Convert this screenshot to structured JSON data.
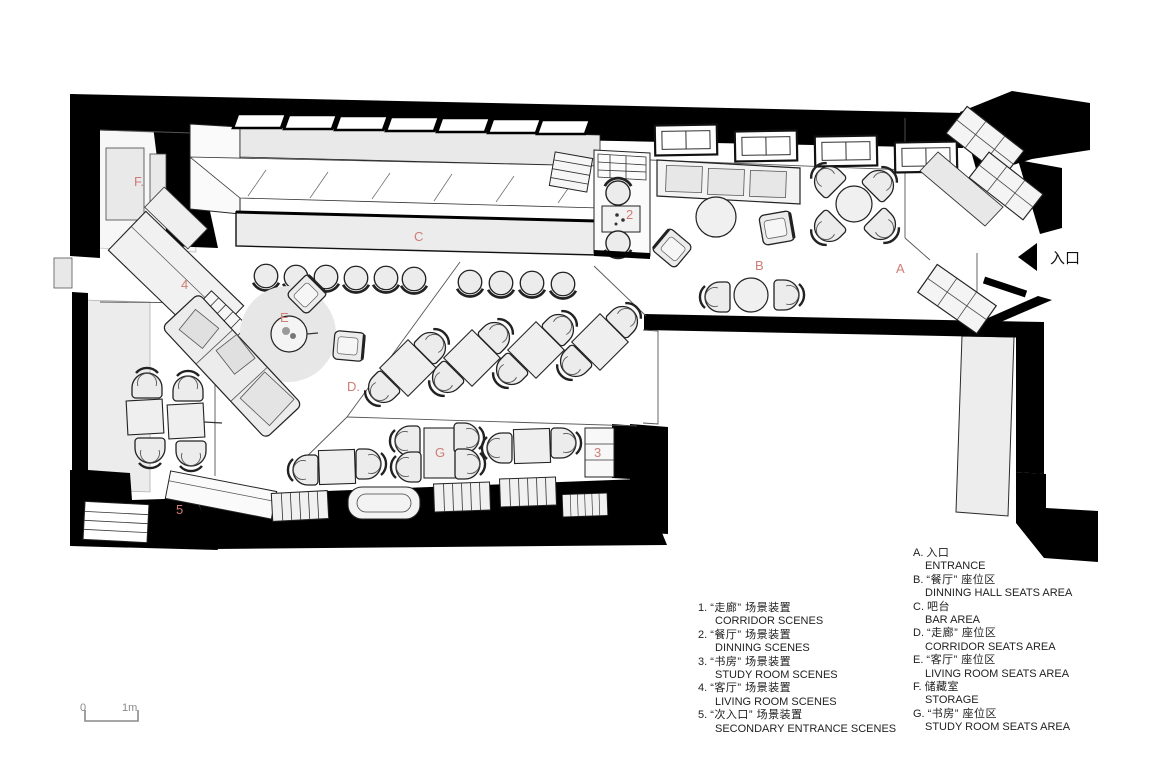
{
  "plan": {
    "entrance_label": "入口",
    "labels": [
      {
        "id": "F",
        "text": "F.",
        "meaning": "storage"
      },
      {
        "id": "C",
        "text": "C",
        "meaning": "bar area"
      },
      {
        "id": "2",
        "text": "2",
        "meaning": "dining scenes installation"
      },
      {
        "id": "B",
        "text": "B",
        "meaning": "dining hall seats area"
      },
      {
        "id": "A",
        "text": "A",
        "meaning": "entrance"
      },
      {
        "id": "4",
        "text": "4",
        "meaning": "living room scenes installation"
      },
      {
        "id": "E",
        "text": "E",
        "meaning": "living room seats area"
      },
      {
        "id": "D",
        "text": "D.",
        "meaning": "corridor seats area"
      },
      {
        "id": "G",
        "text": "G",
        "meaning": "study room seats area"
      },
      {
        "id": "3",
        "text": "3",
        "meaning": "study room scenes installation"
      },
      {
        "id": "5",
        "text": "5",
        "meaning": "secondary entrance scenes installation"
      }
    ]
  },
  "legend_numbered": {
    "items": [
      {
        "num": "1.",
        "cn": "“走廊” 场景装置",
        "en": "CORRIDOR SCENES"
      },
      {
        "num": "2.",
        "cn": "“餐厅” 场景装置",
        "en": "DINNING  SCENES"
      },
      {
        "num": "3.",
        "cn": "“书房” 场景装置",
        "en": "STUDY ROOM SCENES"
      },
      {
        "num": "4.",
        "cn": "“客厅” 场景装置",
        "en": "LIVING ROOM SCENES"
      },
      {
        "num": "5.",
        "cn": "“次入口” 场景装置",
        "en": "SECONDARY ENTRANCE SCENES"
      }
    ]
  },
  "legend_lettered": {
    "items": [
      {
        "letter": "A.",
        "cn": "入口",
        "en": "ENTRANCE"
      },
      {
        "letter": "B.",
        "cn": "“餐厅” 座位区",
        "en": "DINNING HALL SEATS AREA"
      },
      {
        "letter": "C.",
        "cn": "吧台",
        "en": "BAR AREA"
      },
      {
        "letter": "D.",
        "cn": "“走廊” 座位区",
        "en": "CORRIDOR SEATS AREA"
      },
      {
        "letter": "E.",
        "cn": "“客厅” 座位区",
        "en": "LIVING ROOM SEATS AREA"
      },
      {
        "letter": "F.",
        "cn": "储藏室",
        "en": "STORAGE"
      },
      {
        "letter": "G.",
        "cn": "“书房” 座位区",
        "en": "STUDY ROOM SEATS AREA"
      }
    ]
  },
  "scale_bar": {
    "zero": "0",
    "one": "1m"
  },
  "colors": {
    "label_red": "#cf7d75",
    "wall": "#000000",
    "furniture_fill": "#ececec",
    "scale_gray": "#8a8a8a"
  }
}
